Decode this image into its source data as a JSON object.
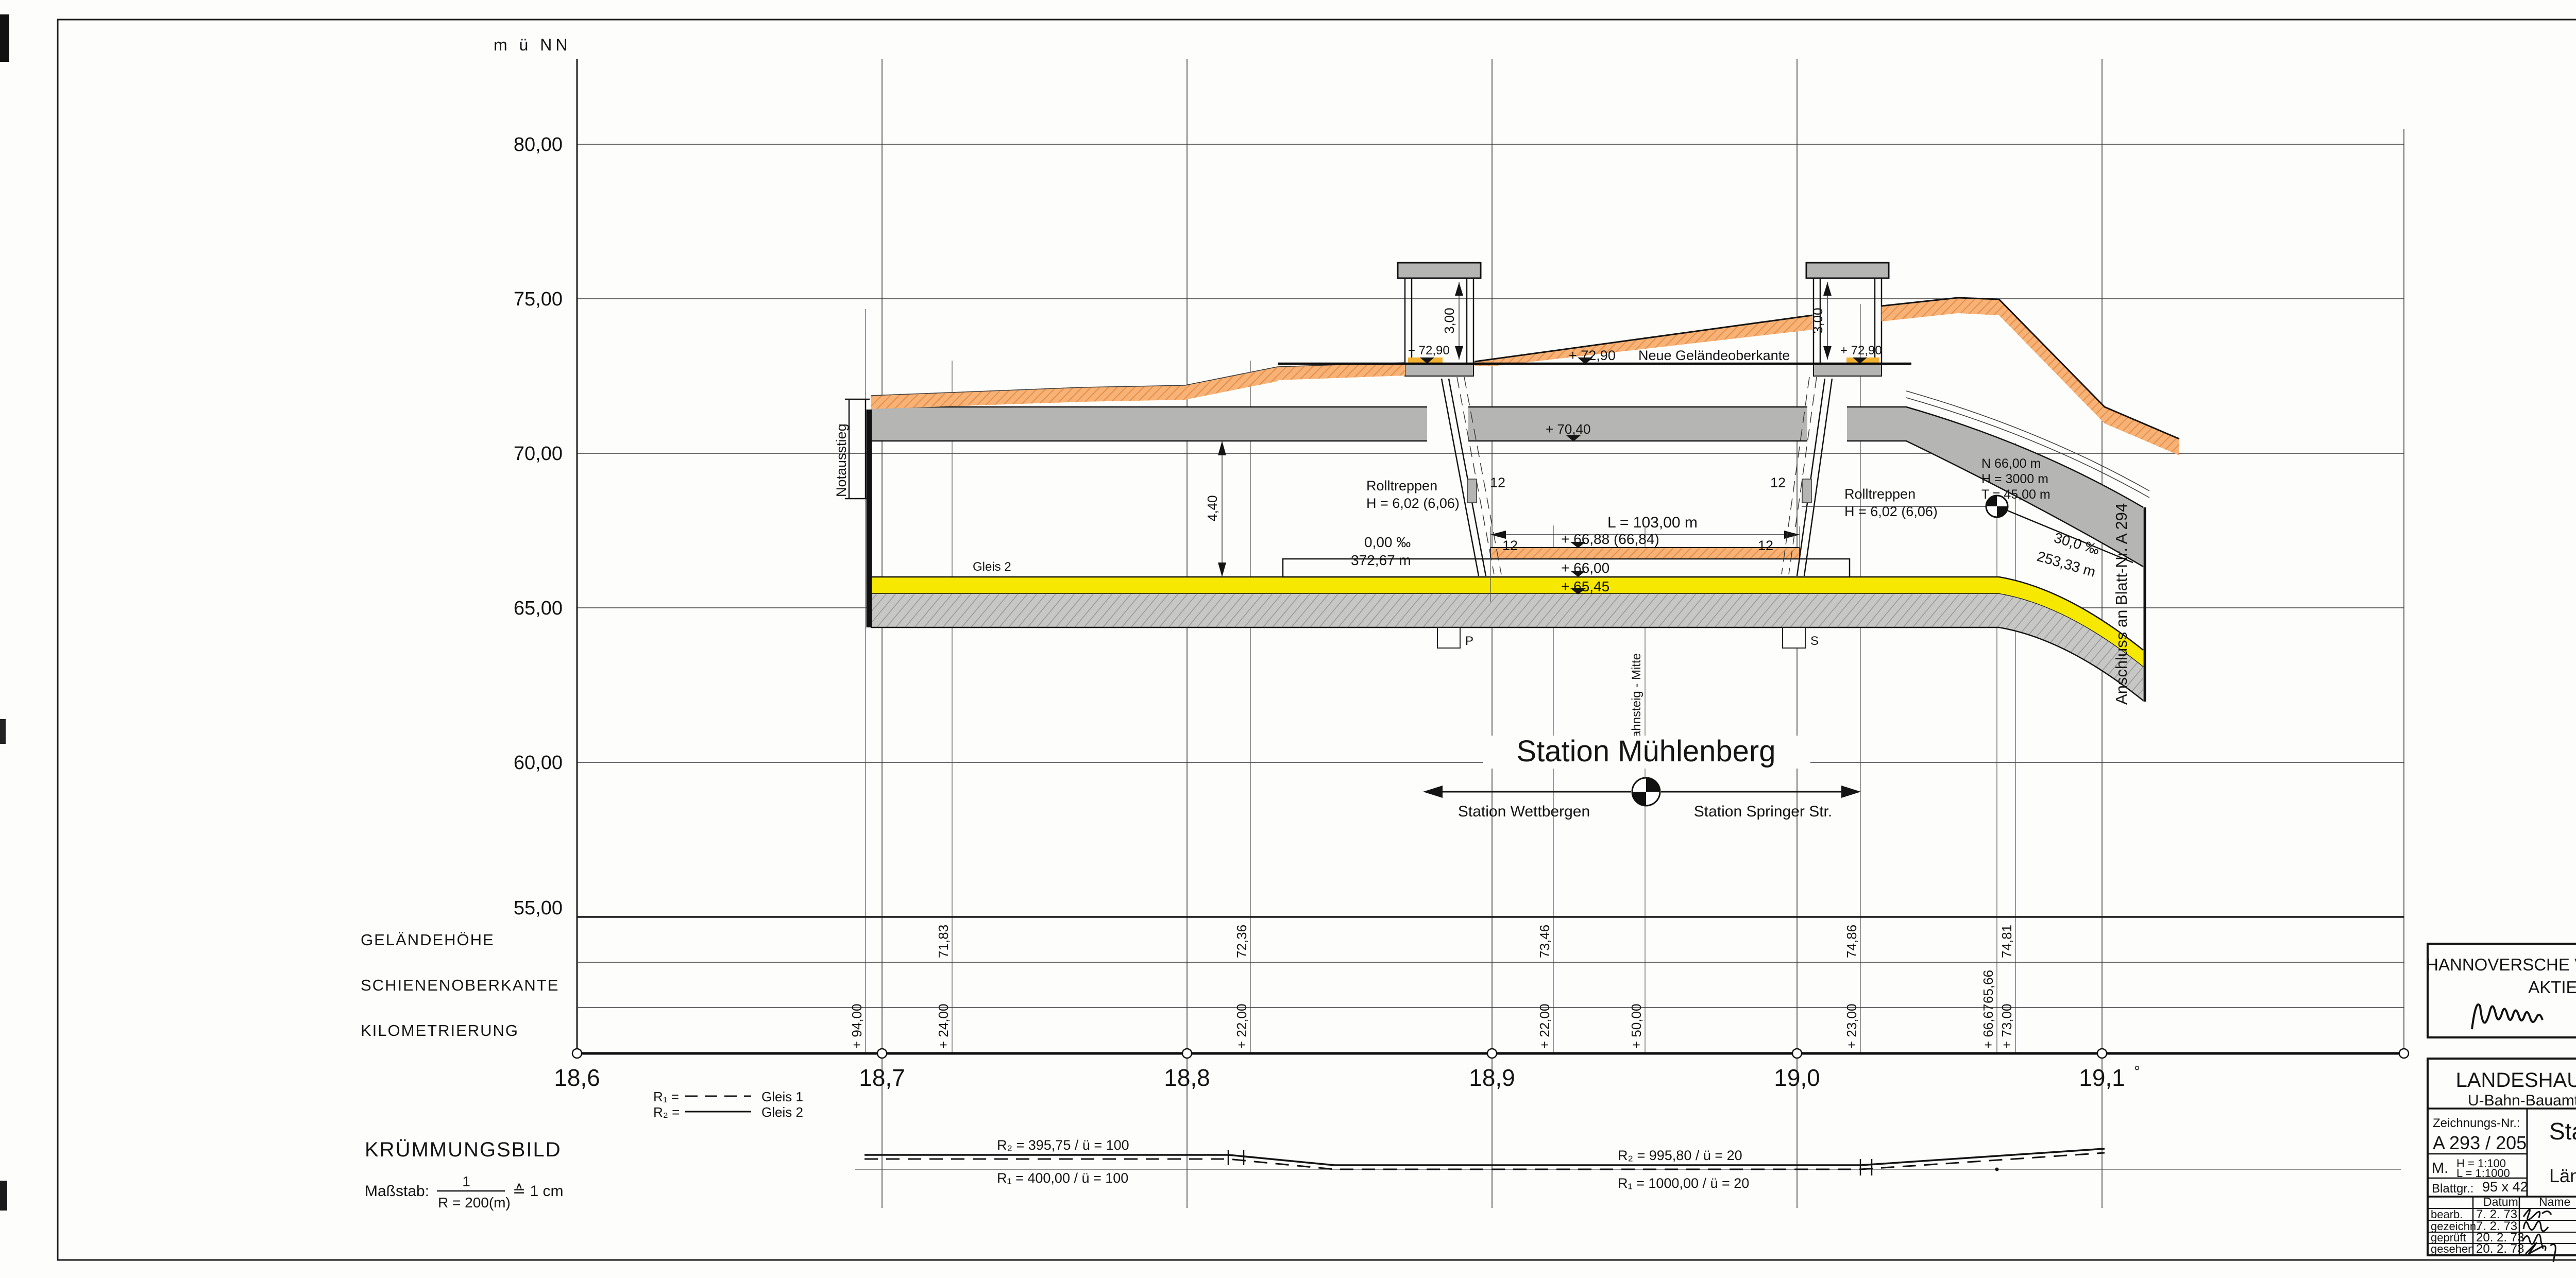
{
  "drawing": {
    "unit_label": "m ü NN",
    "elevations": [
      "80,00",
      "75,00",
      "70,00",
      "65,00",
      "60,00",
      "55,00"
    ],
    "km_ticks": [
      "18,6",
      "18,7",
      "18,8",
      "18,9",
      "19,0",
      "19,1"
    ],
    "km_degree": "°",
    "rows": {
      "gelaendehoehe": "GELÄNDEHÖHE",
      "schienenoberkante": "SCHIENENOBERKANTE",
      "kilometrierung": "KILOMETRIERUNG"
    },
    "gelaende_values": [
      "71,83",
      "72,36",
      "73,46",
      "74,86",
      "74,81"
    ],
    "sok_values": [
      "65,66"
    ],
    "km_values": [
      "+ 94,00",
      "+ 24,00",
      "+ 22,00",
      "+ 22,00",
      "+ 50,00",
      "+ 23,00",
      "+ 66,67",
      "+ 73,00"
    ],
    "station_title": "Station Mühlenberg",
    "dir_left": "Station Wettbergen",
    "dir_right": "Station Springer Str.",
    "bahnsteig_mitte": "Bahnsteig - Mitte",
    "notausstieg": "Notausstieg",
    "gleis2": "Gleis 2",
    "anschluss": "Anschluss an Blatt-Nr. A 294",
    "ann": {
      "neue_gok_value": "+ 72,90",
      "neue_gok_text": "Neue Geländeoberkante",
      "haus_level": "+ 72,90",
      "dim_300": "3,00",
      "dim_440": "4,40",
      "rolltreppen": "Rolltreppen",
      "rolltreppen_h": "H = 6,02 (6,06)",
      "twelve": "12",
      "level_7040": "+ 70,40",
      "grad1_a": "0,00 ‰",
      "grad1_b": "372,67 m",
      "platform_len": "L = 103,00 m",
      "level_6688": "+ 66,88 (66,84)",
      "level_6600": "+ 66,00",
      "level_6545": "+ 65,45",
      "nht_1": "N   66,00 m",
      "nht_2": "H = 3000 m",
      "nht_3": "T = 45,00 m",
      "grad2_a": "30,0 ‰",
      "grad2_b": "253,33 m",
      "sump_p": "P",
      "sump_s": "S"
    },
    "colors": {
      "orange": "#f09d5a",
      "yellow": "#f6e800",
      "gray": "#b5b5b3"
    }
  },
  "kruemmung": {
    "title": "KRÜMMUNGSBILD",
    "massstab_label": "Maßstab:",
    "frac_num": "1",
    "frac_den": "R = 200(m)",
    "frac_eq": "≙ 1 cm",
    "legend_r1": "R₁ =",
    "legend_r1_track": "Gleis 1",
    "legend_r2": "R₂ =",
    "legend_r2_track": "Gleis 2",
    "seg1_r2": "R₂ = 395,75 / ü = 100",
    "seg1_r1": "R₁ = 400,00 / ü = 100",
    "seg2_r2": "R₂ = 995,80 / ü = 20",
    "seg2_r1": "R₁ = 1000,00 / ü = 20"
  },
  "ustra_block": {
    "line1": "HANNOVERSCHE VERKEHRSBETRIEBE (ÜSTRA)",
    "line2": "AKTIENGESELLSCHAFT",
    "date_label": "Hannover, den",
    "date": "3.4.1973"
  },
  "lhh_block": {
    "title": "LANDESHAUPTSTADT HANNOVER",
    "sub_left": "U-Bahn-Bauamt",
    "sub_right": "Techn. Abt. 691",
    "zeich_label": "Zeichnungs-Nr.:",
    "zeich_nr": "A 293 / 205",
    "m_label": "M.",
    "m_h": "H = 1:100",
    "m_l": "L = 1:1000",
    "blatt_label": "Blattgr.:",
    "blatt_value": "95 x 42",
    "station": "Station Mühlenberg",
    "schnitt": "Längsschnitt",
    "table": {
      "col_datum": "Datum",
      "col_name": "Name",
      "col_ersatz": "Ersatz für:",
      "row_ersetzt": "ersetzt durch:",
      "row_geaendert": "geändert:",
      "r1_label": "bearb.",
      "r1_date": "7. 2. 73",
      "r2_label": "gezeichn.",
      "r2_date": "7. 2. 73",
      "r3_label": "geprüft",
      "r3_date": "20. 2. 73",
      "r4_label": "gesehen",
      "r4_date": "20. 2. 73",
      "city_label": "HANNOVER, den",
      "city_date": "23. 2. 73"
    }
  }
}
